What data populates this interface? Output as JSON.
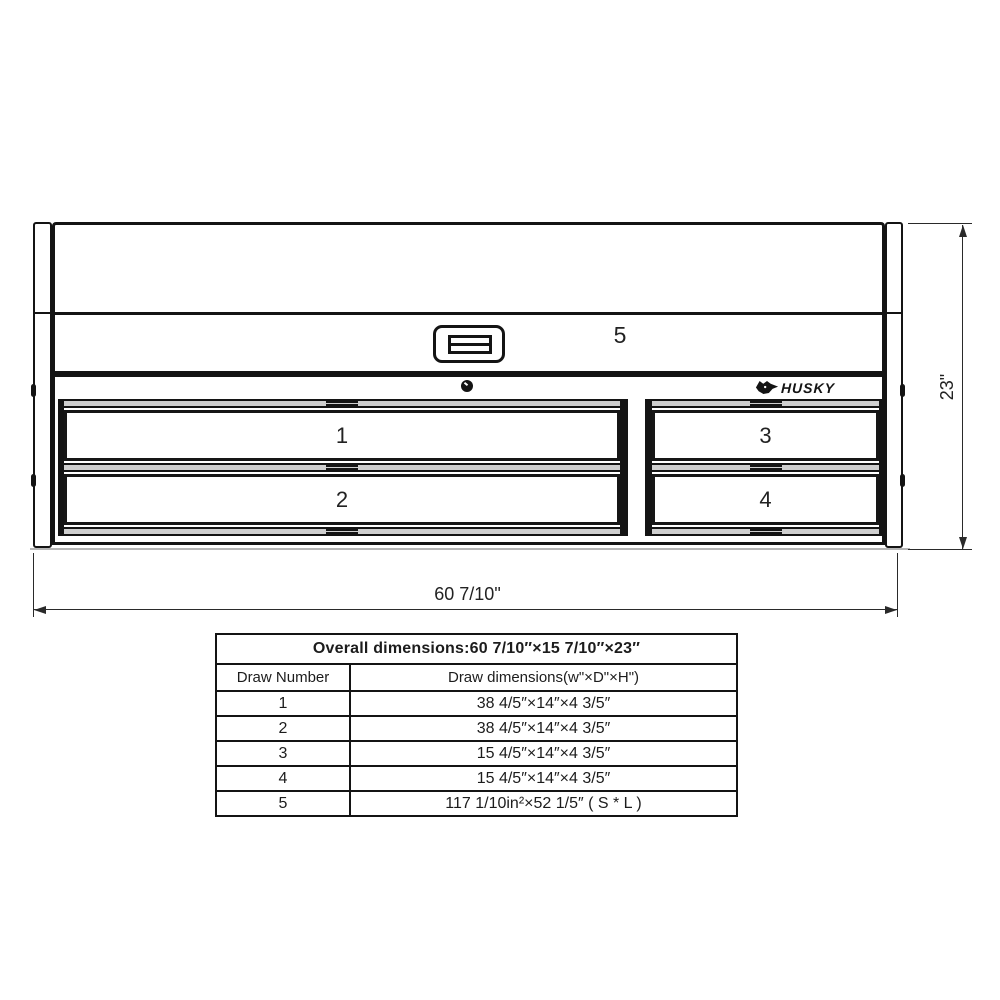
{
  "colors": {
    "line": "#141414",
    "background": "#ffffff",
    "rail_gray": "#cfcfcf"
  },
  "diagram": {
    "brand": "HUSKY",
    "width_label": "60 7/10\"",
    "height_label": "23\"",
    "drawers": [
      {
        "label": "1"
      },
      {
        "label": "2"
      },
      {
        "label": "3"
      },
      {
        "label": "4"
      },
      {
        "label": "5"
      }
    ]
  },
  "table": {
    "title": "Overall dimensions:60 7/10″×15 7/10″×23″",
    "columns": [
      "Draw Number",
      "Draw dimensions(w\"×D\"×H\")"
    ],
    "rows": [
      {
        "number": "1",
        "dimensions": "38 4/5″×14″×4 3/5″"
      },
      {
        "number": "2",
        "dimensions": "38 4/5″×14″×4 3/5″"
      },
      {
        "number": "3",
        "dimensions": "15 4/5″×14″×4 3/5″"
      },
      {
        "number": "4",
        "dimensions": "15 4/5″×14″×4 3/5″"
      },
      {
        "number": "5",
        "dimensions": "117 1/10in²×52 1/5″ ( S * L )"
      }
    ]
  }
}
